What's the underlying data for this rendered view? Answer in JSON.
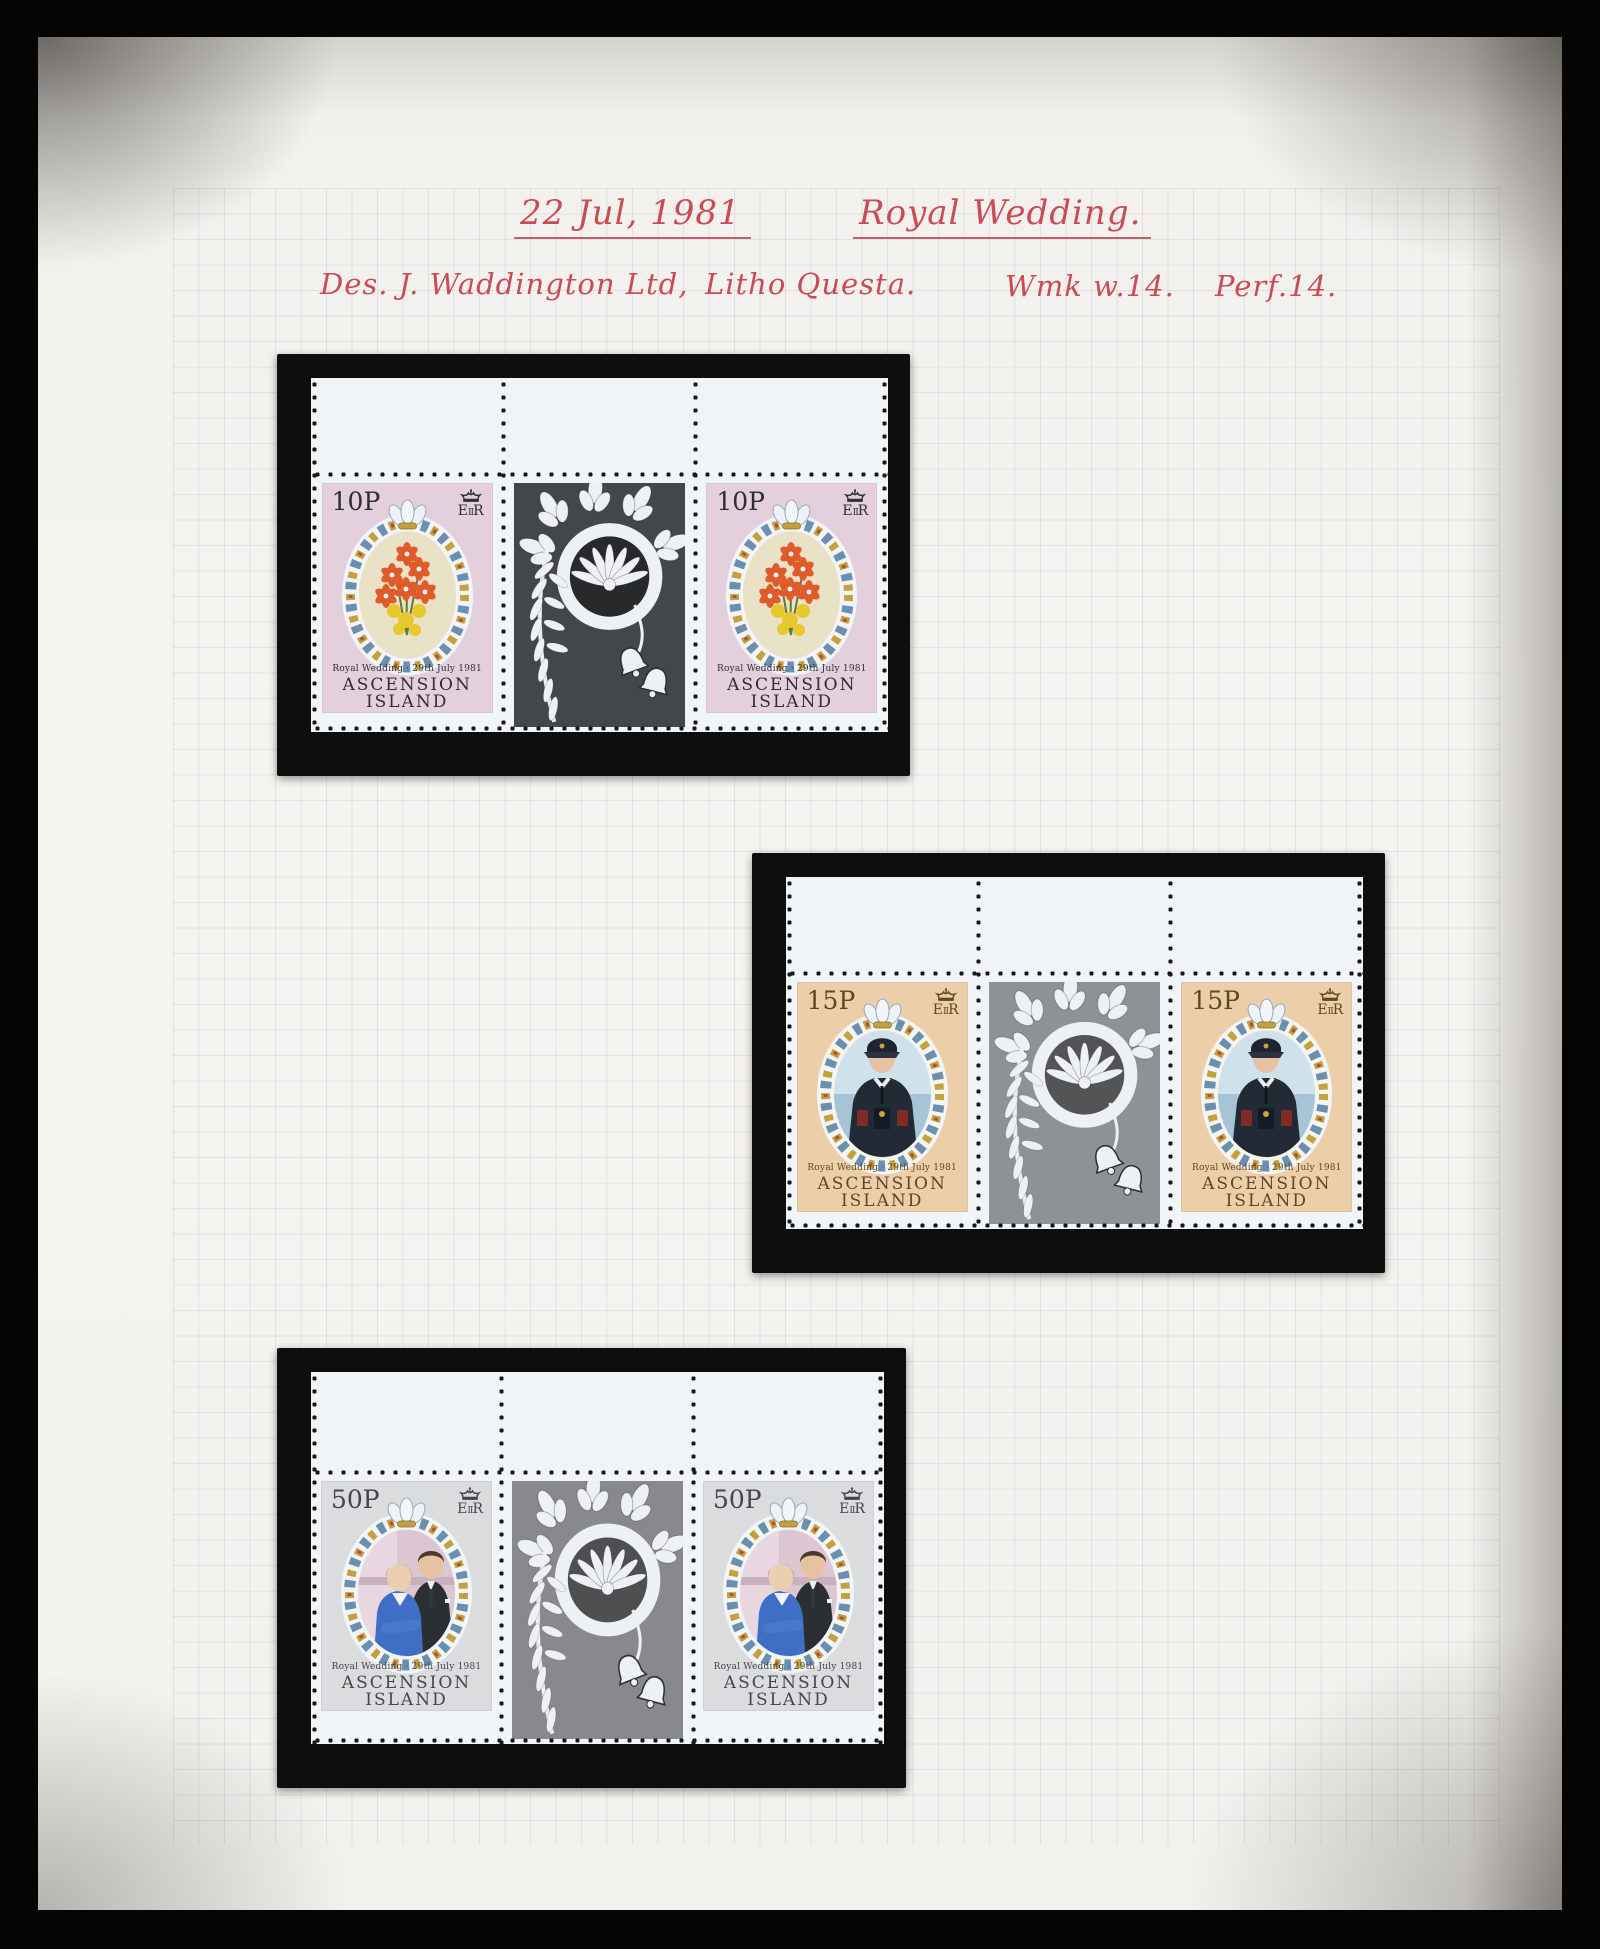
{
  "heading": {
    "date": "22 Jul, 1981",
    "title": "Royal Wedding."
  },
  "details": {
    "designer": "Des. J. Waddington Ltd,",
    "process": "Litho Questa.",
    "watermark": "Wmk w.14.",
    "perforation": "Perf.14."
  },
  "ink_color": "#c84b55",
  "album": {
    "page_color": "#f3f2ee",
    "mount_color": "#0e0e0e",
    "photo_border_color": "#050505"
  },
  "blocks": [
    {
      "id": "10p",
      "denomination": "10P",
      "monogram": {
        "left": "E",
        "small": "II",
        "right": "R"
      },
      "caption": "Royal Wedding · 29th July 1981",
      "country_line1": "ASCENSION",
      "country_line2": "ISLAND",
      "subject": "bouquet-of-orange-lilies",
      "colors": {
        "stamp_bg": "#e4d0dc",
        "oval_bg": "#eae2c6",
        "gutter_bg": "#44474a",
        "text": "#2e2e36"
      }
    },
    {
      "id": "15p",
      "denomination": "15P",
      "monogram": {
        "left": "E",
        "small": "II",
        "right": "R"
      },
      "caption": "Royal Wedding · 29th July 1981",
      "country_line1": "ASCENSION",
      "country_line2": "ISLAND",
      "subject": "prince-charles-in-naval-uniform",
      "colors": {
        "stamp_bg": "#eccfa9",
        "gutter_bg": "#8e9295",
        "text": "#5e4628"
      }
    },
    {
      "id": "50p",
      "denomination": "50P",
      "monogram": {
        "left": "E",
        "small": "II",
        "right": "R"
      },
      "caption": "Royal Wedding · 29th July 1981",
      "country_line1": "ASCENSION",
      "country_line2": "ISLAND",
      "subject": "prince-charles-and-lady-diana",
      "colors": {
        "stamp_bg": "#dbdcde",
        "gutter_bg": "#87898c",
        "text": "#44464a"
      }
    }
  ]
}
